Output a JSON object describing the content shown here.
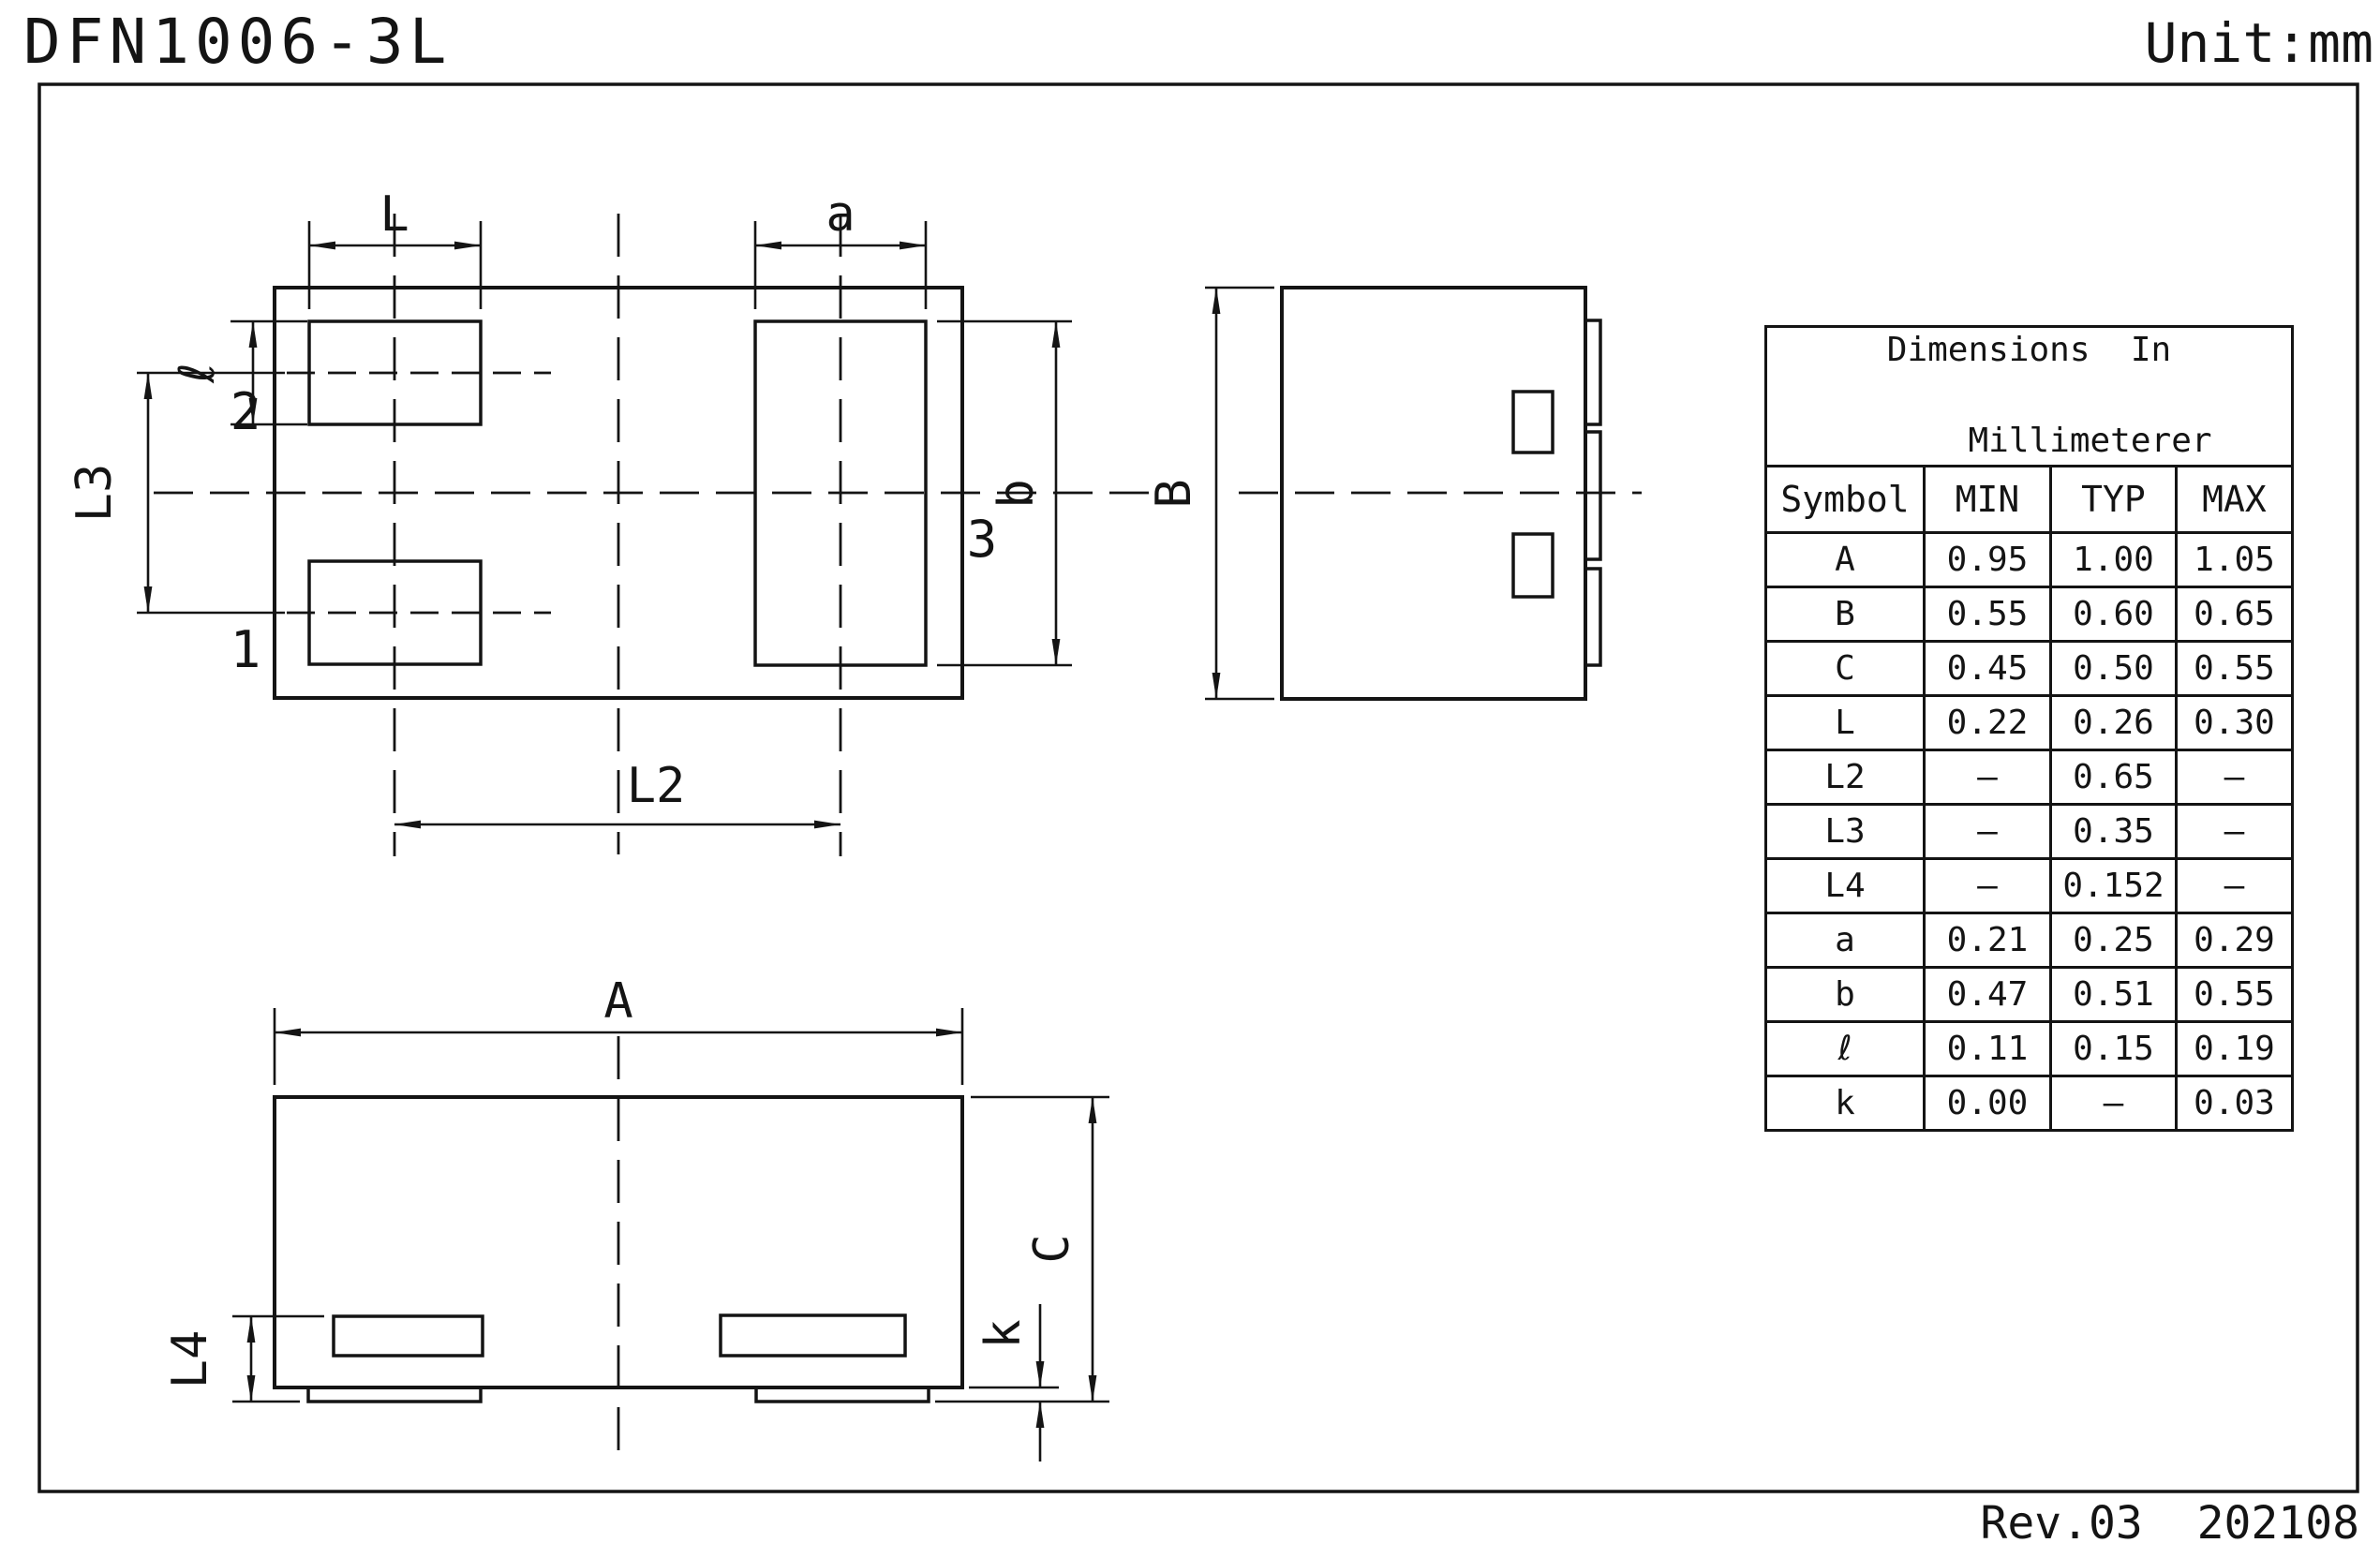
{
  "page": {
    "title": "DFN1006-3L",
    "unit": "Unit:mm",
    "revision": "Rev.03  202108"
  },
  "labels": {
    "top_view": {
      "L": "L",
      "a": "a",
      "l": "ℓ",
      "L3": "L3",
      "L2": "L2",
      "b": "b",
      "pin1": "1",
      "pin2": "2",
      "pin3": "3"
    },
    "side_view": {
      "B": "B"
    },
    "bottom_view": {
      "A": "A",
      "L4": "L4",
      "C": "C",
      "k": "k"
    }
  },
  "table": {
    "title_line1": "Dimensions  In",
    "title_line2": "Millimeterer",
    "headers": [
      "Symbol",
      "MIN",
      "TYP",
      "MAX"
    ],
    "rows": [
      {
        "symbol": "A",
        "min": "0.95",
        "typ": "1.00",
        "max": "1.05"
      },
      {
        "symbol": "B",
        "min": "0.55",
        "typ": "0.60",
        "max": "0.65"
      },
      {
        "symbol": "C",
        "min": "0.45",
        "typ": "0.50",
        "max": "0.55"
      },
      {
        "symbol": "L",
        "min": "0.22",
        "typ": "0.26",
        "max": "0.30"
      },
      {
        "symbol": "L2",
        "min": "–",
        "typ": "0.65",
        "max": "–"
      },
      {
        "symbol": "L3",
        "min": "–",
        "typ": "0.35",
        "max": "–"
      },
      {
        "symbol": "L4",
        "min": "–",
        "typ": "0.152",
        "max": "–"
      },
      {
        "symbol": "a",
        "min": "0.21",
        "typ": "0.25",
        "max": "0.29"
      },
      {
        "symbol": "b",
        "min": "0.47",
        "typ": "0.51",
        "max": "0.55"
      },
      {
        "symbol": "ℓ",
        "min": "0.11",
        "typ": "0.15",
        "max": "0.19"
      },
      {
        "symbol": "k",
        "min": "0.00",
        "typ": "–",
        "max": "0.03"
      }
    ]
  }
}
